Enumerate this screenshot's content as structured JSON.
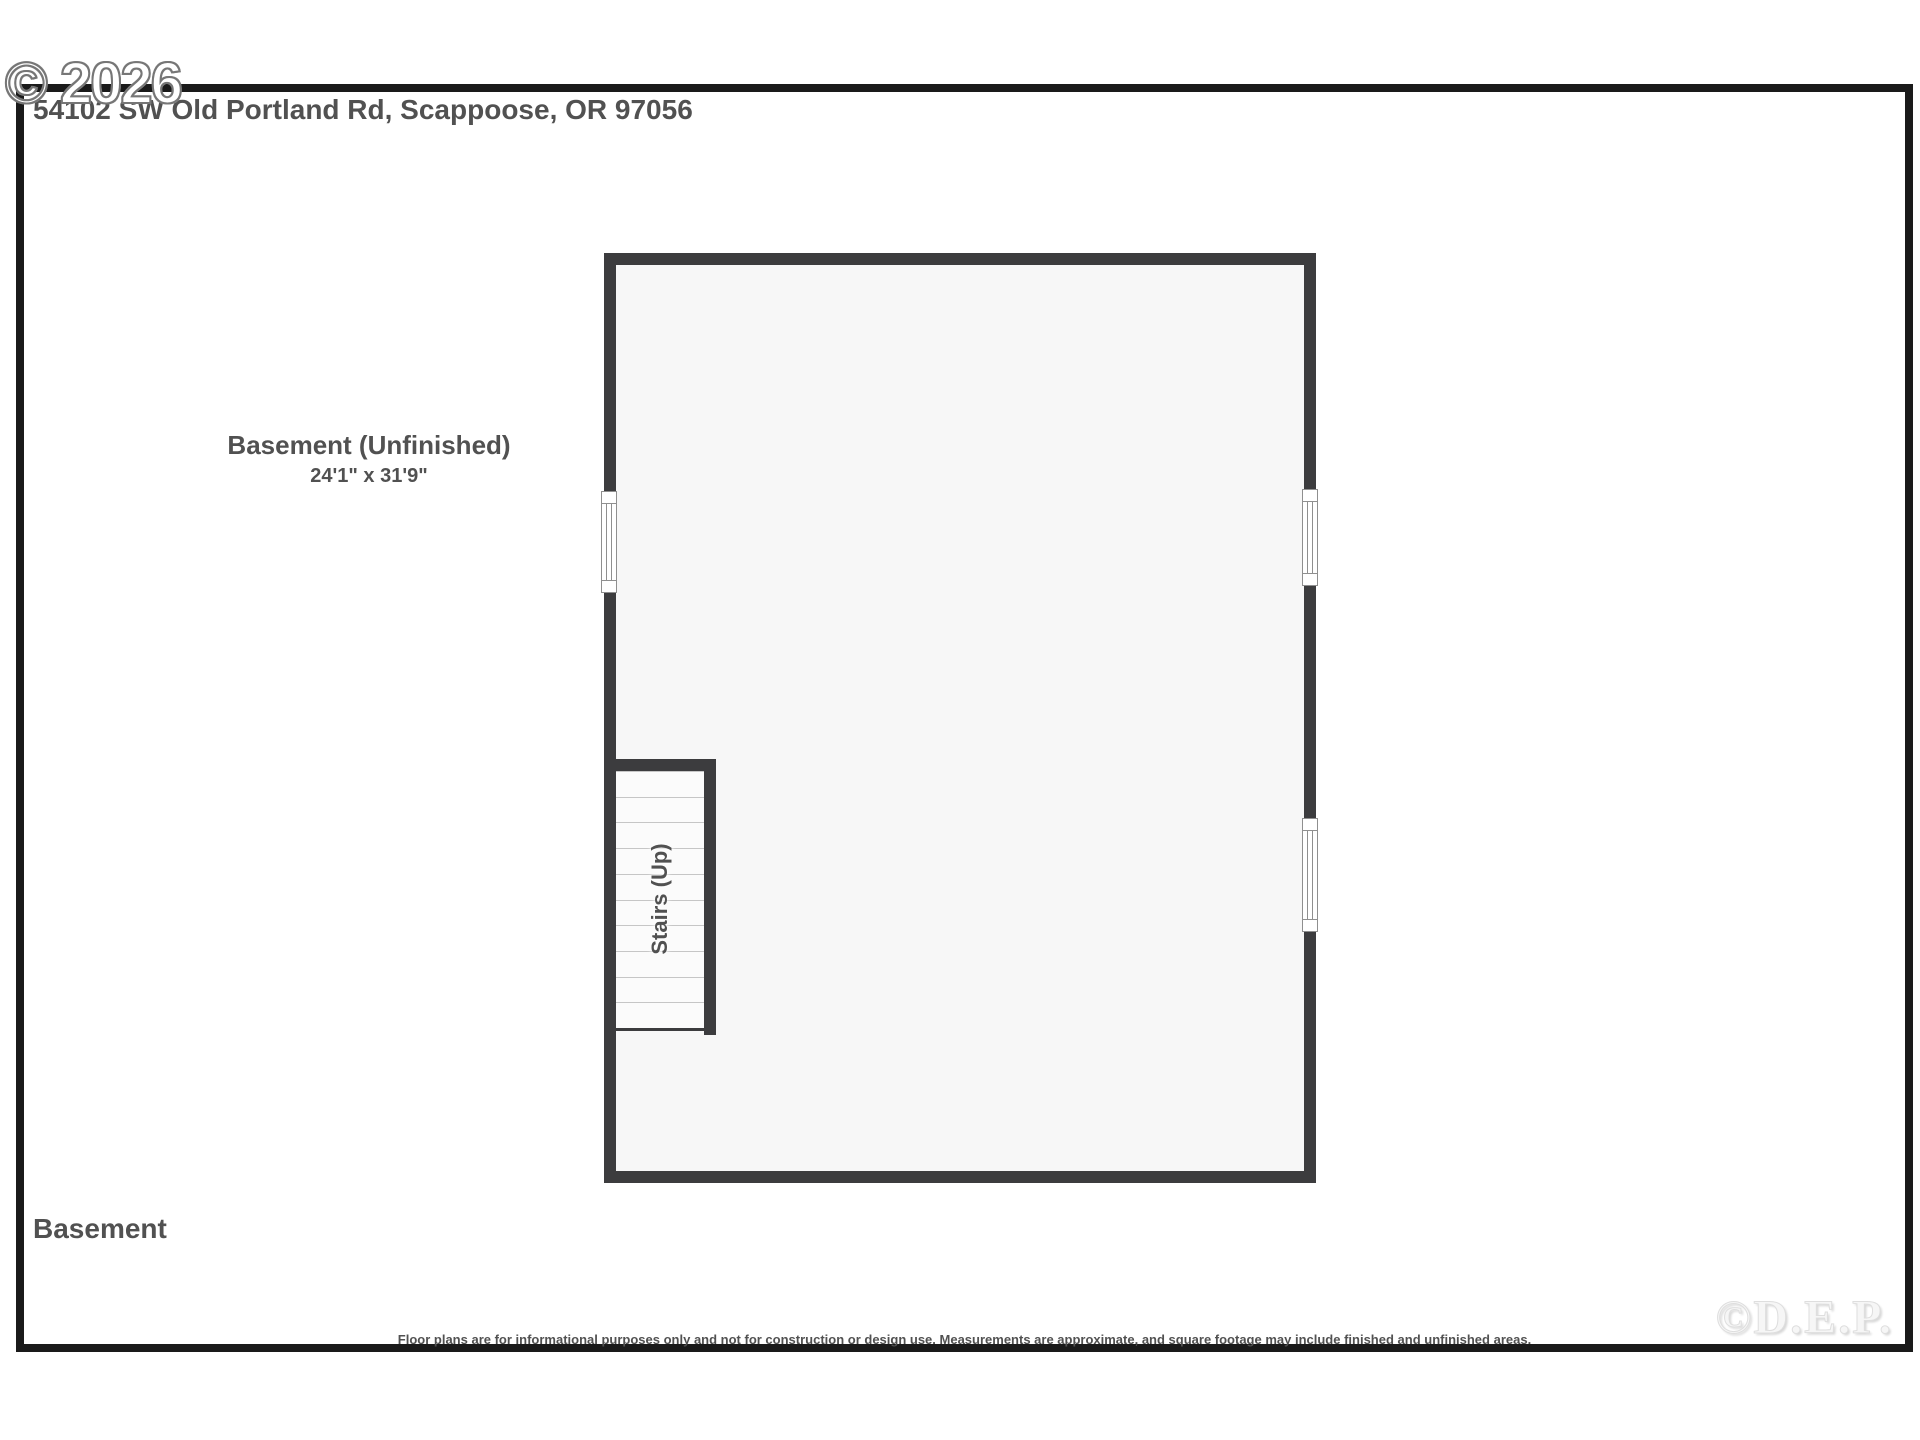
{
  "header": {
    "address": "54102 SW Old Portland Rd, Scappoose, OR 97056",
    "copyright_watermark": "© 2026"
  },
  "floor_plan": {
    "room": {
      "name": "Basement (Unfinished)",
      "dimensions": "24'1\" x 31'9\""
    },
    "stairs": {
      "label": "Stairs (Up)",
      "step_count": 10
    },
    "windows": [
      "left-wall-window",
      "right-wall-upper-window",
      "right-wall-lower-window"
    ]
  },
  "footer": {
    "floor_label": "Basement",
    "disclaimer": "Floor plans are for informational purposes only and not for construction or design use. Measurements are approximate, and square footage may include finished and unfinished areas.",
    "brand_watermark": "©D.E.P."
  },
  "colors": {
    "wall": "#3c3c3e",
    "interior_fill": "#f7f7f7",
    "text": "#515151",
    "step_line": "#c6c6c6",
    "frame_border": "#1a1a1a",
    "window_frame": "#8f8f8f"
  }
}
